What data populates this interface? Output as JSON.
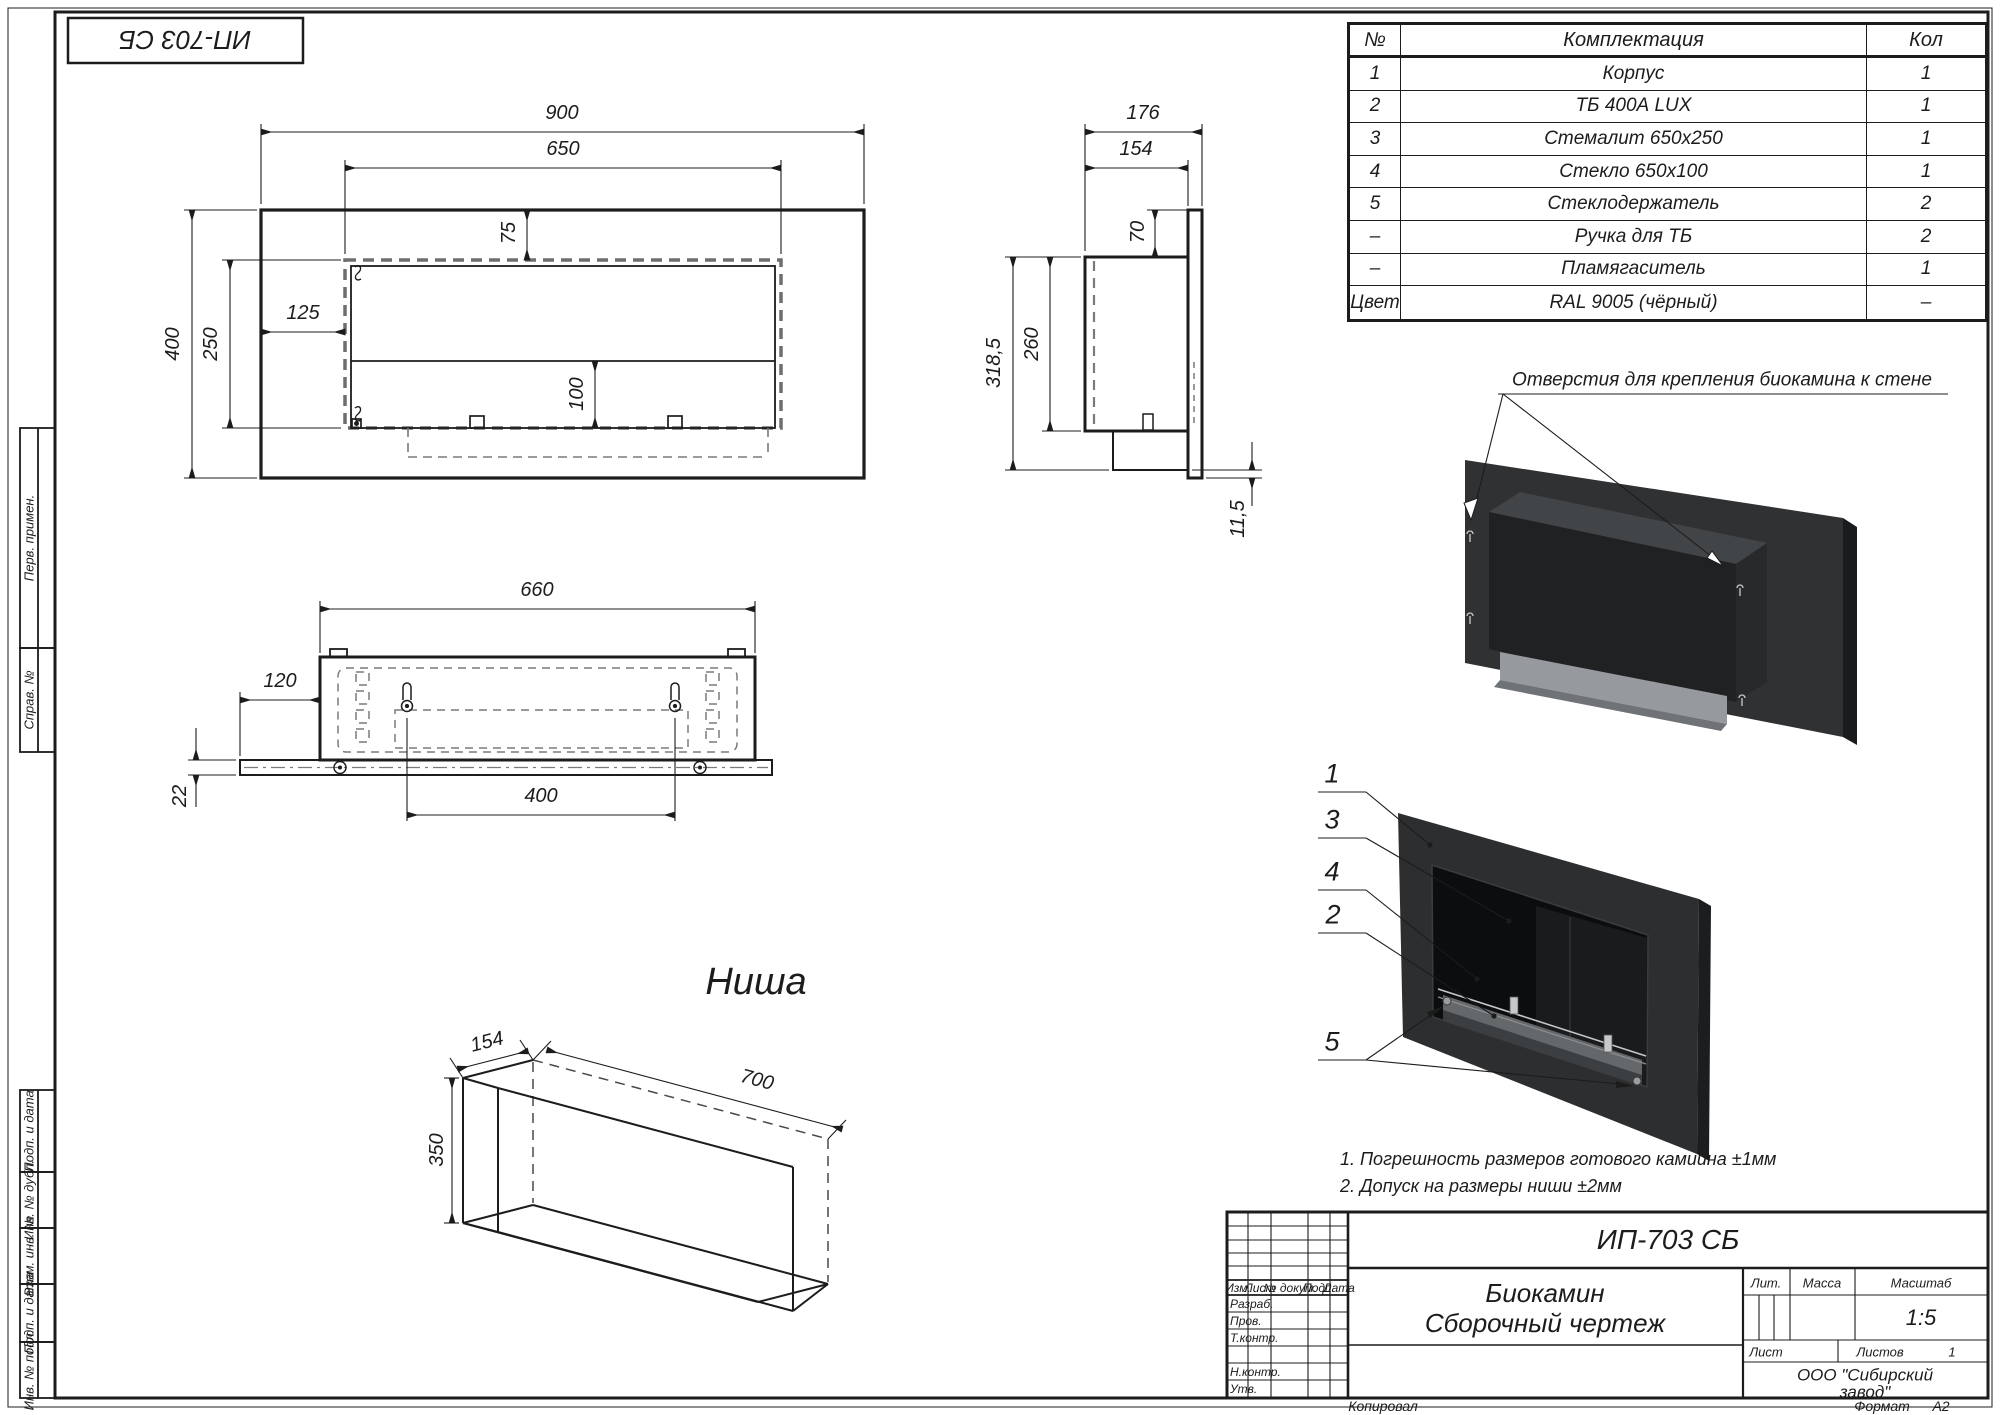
{
  "sheet": {
    "stamp": "ИП-703 СБ",
    "copied": "Копировал",
    "format_label": "Формат",
    "format_value": "А2"
  },
  "margin": {
    "labels": [
      "Перв. примен.",
      "Справ. №",
      "Подп. и дата",
      "Инв. № дубл.",
      "Взам. инв. №",
      "Подп. и дата",
      "Инв. № подл."
    ]
  },
  "parts_table": {
    "headers": [
      "№",
      "Комплектация",
      "Кол"
    ],
    "rows": [
      [
        "1",
        "Корпус",
        "1"
      ],
      [
        "2",
        "ТБ 400А LUX",
        "1"
      ],
      [
        "3",
        "Стемалит 650х250",
        "1"
      ],
      [
        "4",
        "Стекло 650х100",
        "1"
      ],
      [
        "5",
        "Стеклодержатель",
        "2"
      ],
      [
        "–",
        "Ручка для ТБ",
        "2"
      ],
      [
        "–",
        "Пламягаситель",
        "1"
      ],
      [
        "Цвет",
        "RAL 9005 (чёрный)",
        "–"
      ]
    ]
  },
  "front_view": {
    "d900": "900",
    "d650": "650",
    "d400": "400",
    "d250": "250",
    "d125": "125",
    "d75": "75",
    "d100": "100"
  },
  "side_view": {
    "d176": "176",
    "d154": "154",
    "d70": "70",
    "d260": "260",
    "d318": "318,5",
    "d115": "11,5"
  },
  "bottom_view": {
    "d660": "660",
    "d120": "120",
    "d22": "22",
    "d400": "400"
  },
  "niche": {
    "title": "Ниша",
    "d154": "154",
    "d350": "350",
    "d700": "700"
  },
  "back3d": {
    "callout": "Отверстия для крепления биокамина к стене"
  },
  "front3d": {
    "c1": "1",
    "c3": "3",
    "c4": "4",
    "c2": "2",
    "c5": "5"
  },
  "notes": {
    "n1": "1. Погрешность размеров готового камиина ±1мм",
    "n2": "2. Допуск на размеры ниши ±2мм"
  },
  "title_block": {
    "doc_number": "ИП-703 СБ",
    "product": "Биокамин",
    "doc_type": "Сборочный чертеж",
    "col_izm": "Изм.",
    "col_list": "Лист",
    "col_dokum": "№ докум.",
    "col_podp": "Подп.",
    "col_data": "Дата",
    "row_razrab": "Разраб.",
    "row_prov": "Пров.",
    "row_tkontr": "Т.контр.",
    "row_nkontr": "Н.контр.",
    "row_utv": "Утв.",
    "lit": "Лит.",
    "massa": "Масса",
    "masshtab": "Масштаб",
    "scale": "1:5",
    "list_label": "Лист",
    "listov_label": "Листов",
    "listov_value": "1",
    "org1": "ООО \"Сибирский",
    "org2": "завод\""
  }
}
